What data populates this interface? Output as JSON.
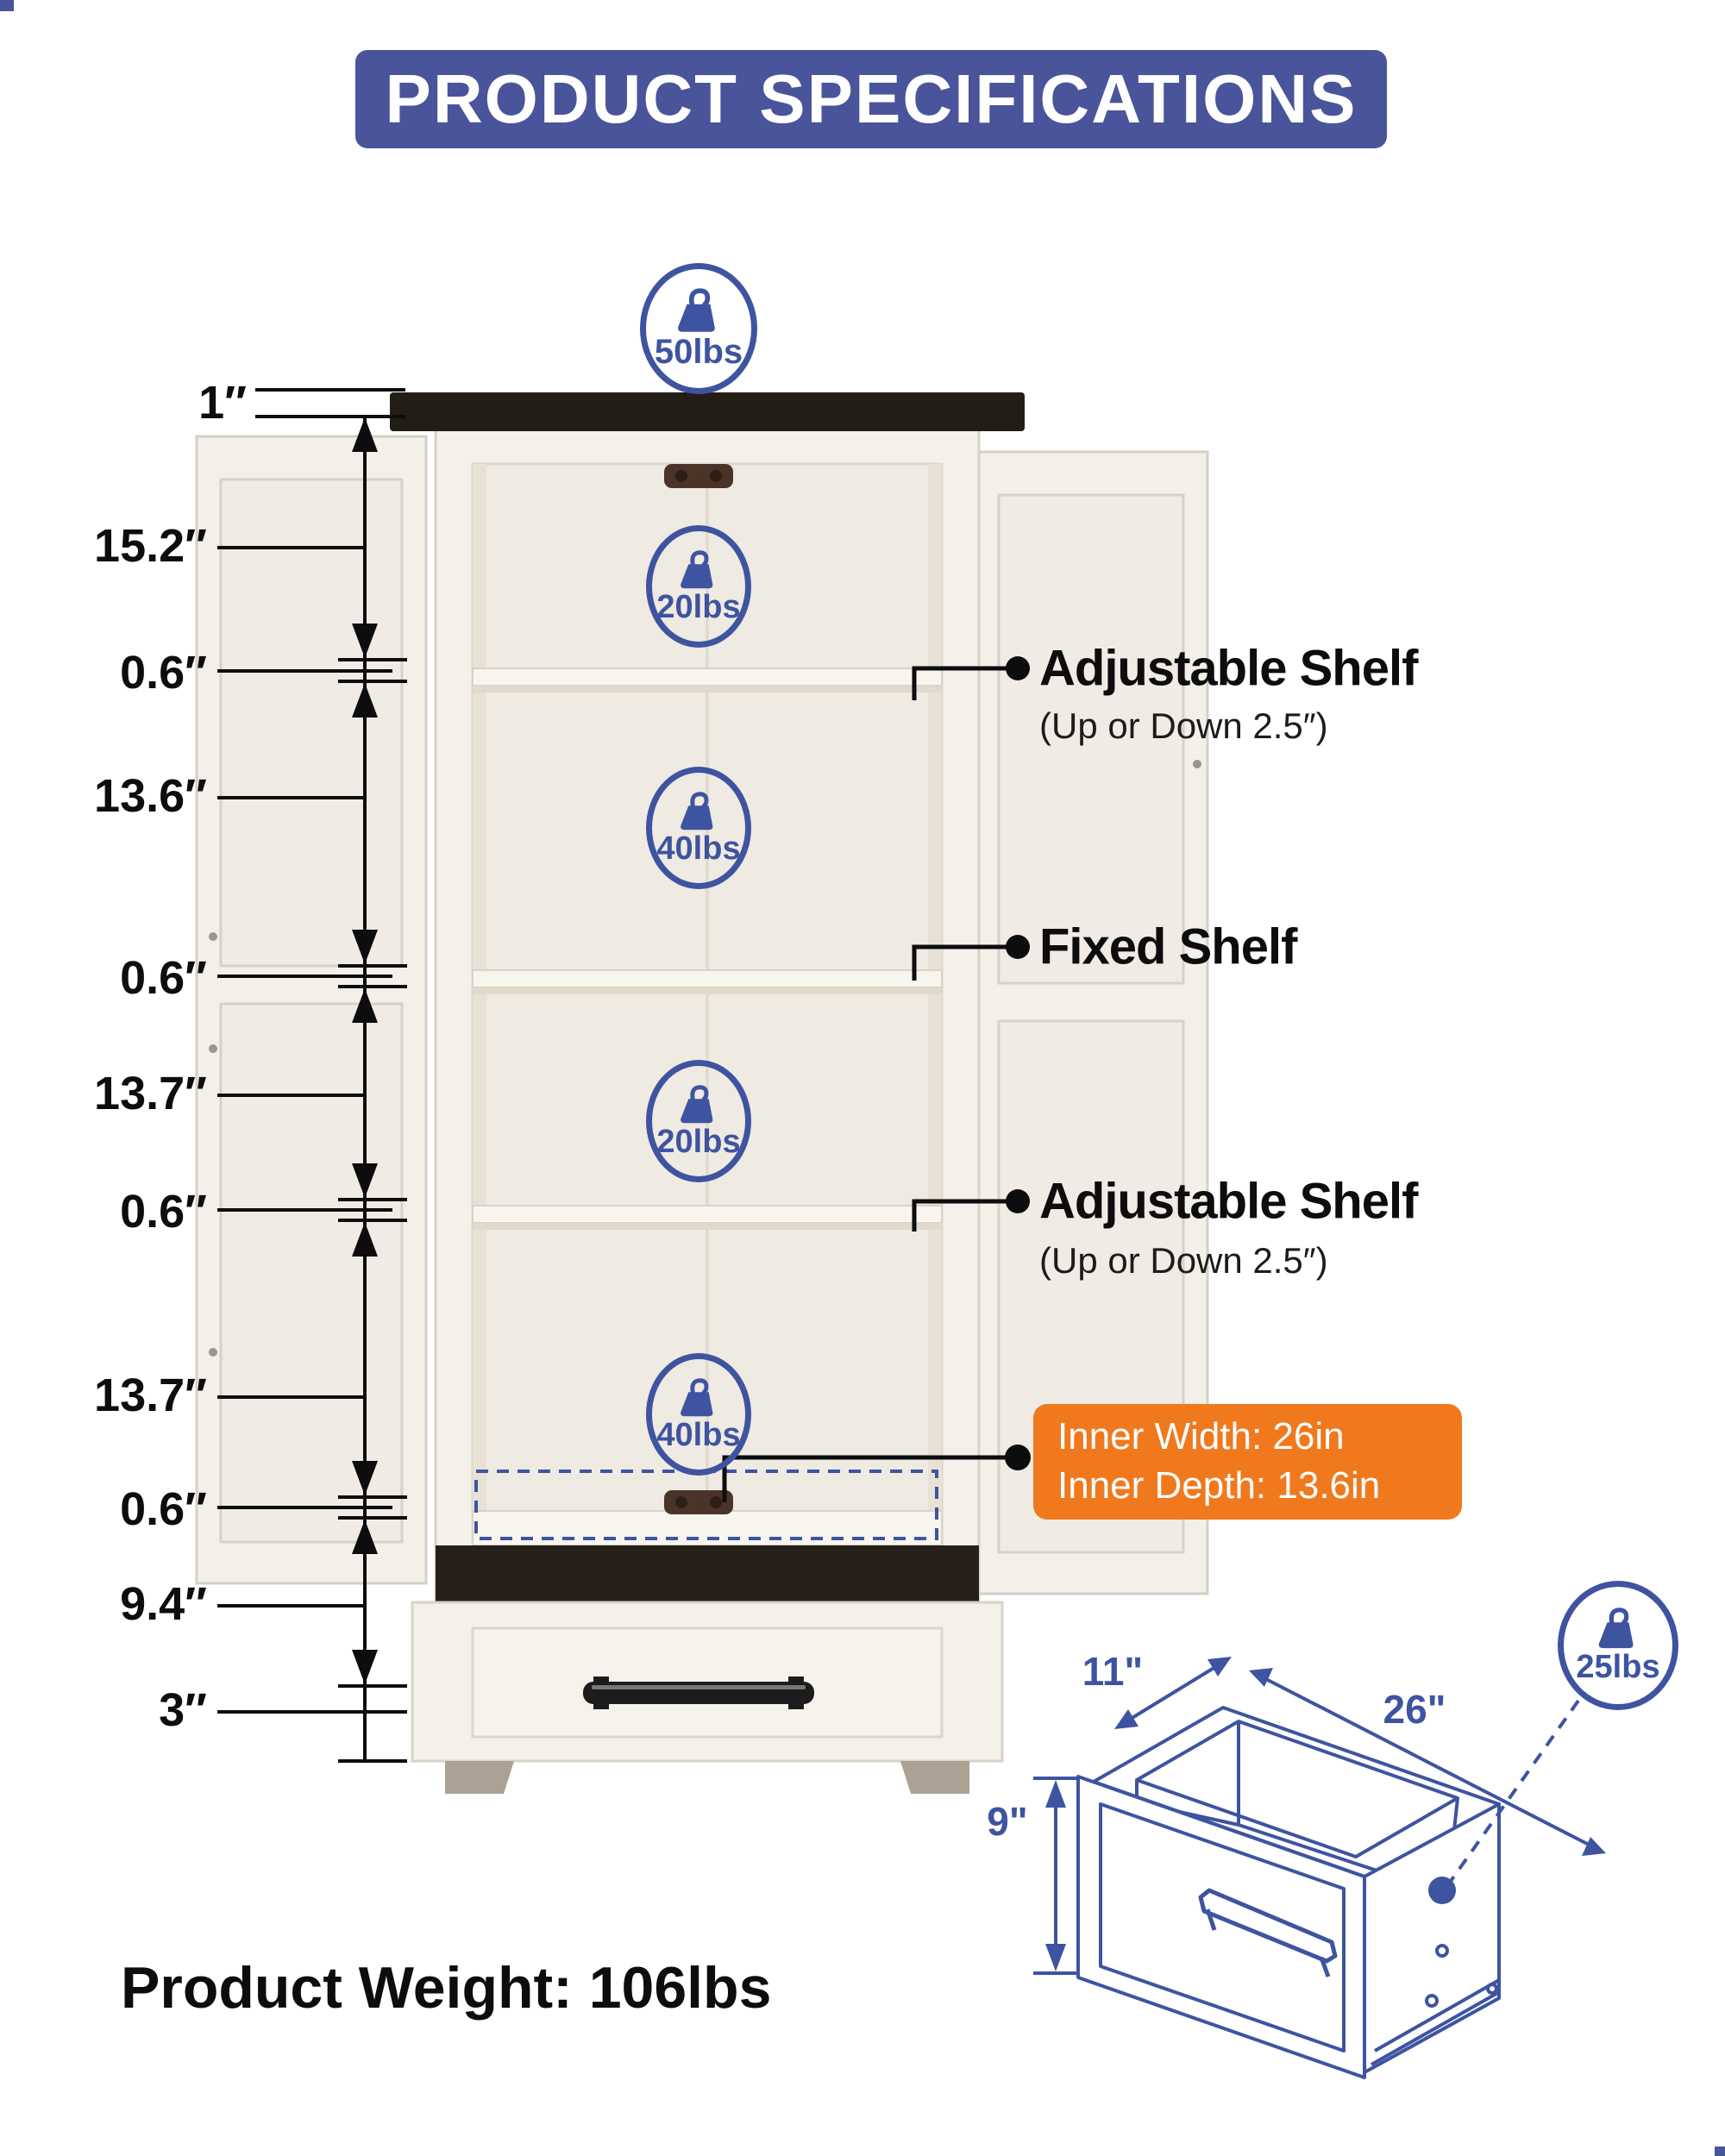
{
  "page": {
    "title": "PRODUCT SPECIFICATIONS",
    "product_weight": "Product Weight: 106lbs"
  },
  "colors": {
    "banner_blue": "#4A549B",
    "diagram_blue": "#3E54A0",
    "accent_orange": "#F0791E",
    "text_black": "#0d0d0d"
  },
  "capacity_badges": {
    "top": "50lbs",
    "section1": "20lbs",
    "section2": "40lbs",
    "section3": "20lbs",
    "section4": "40lbs",
    "drawer": "25lbs"
  },
  "dimension_labels": [
    "1″",
    "15.2″",
    "0.6″",
    "13.6″",
    "0.6″",
    "13.7″",
    "0.6″",
    "13.7″",
    "0.6″",
    "9.4″",
    "3″"
  ],
  "callouts": {
    "shelf_top": {
      "title": "Adjustable Shelf",
      "subtitle": "(Up or Down 2.5″)"
    },
    "shelf_middle": {
      "title": "Fixed Shelf"
    },
    "shelf_bottom": {
      "title": "Adjustable Shelf",
      "subtitle": "(Up or Down 2.5″)"
    },
    "inner_dimensions": {
      "line1": "Inner Width: 26in",
      "line2": "Inner Depth: 13.6in"
    }
  },
  "drawer_diagram": {
    "depth_label": "11\"",
    "width_label": "26\"",
    "height_label": "9\""
  }
}
